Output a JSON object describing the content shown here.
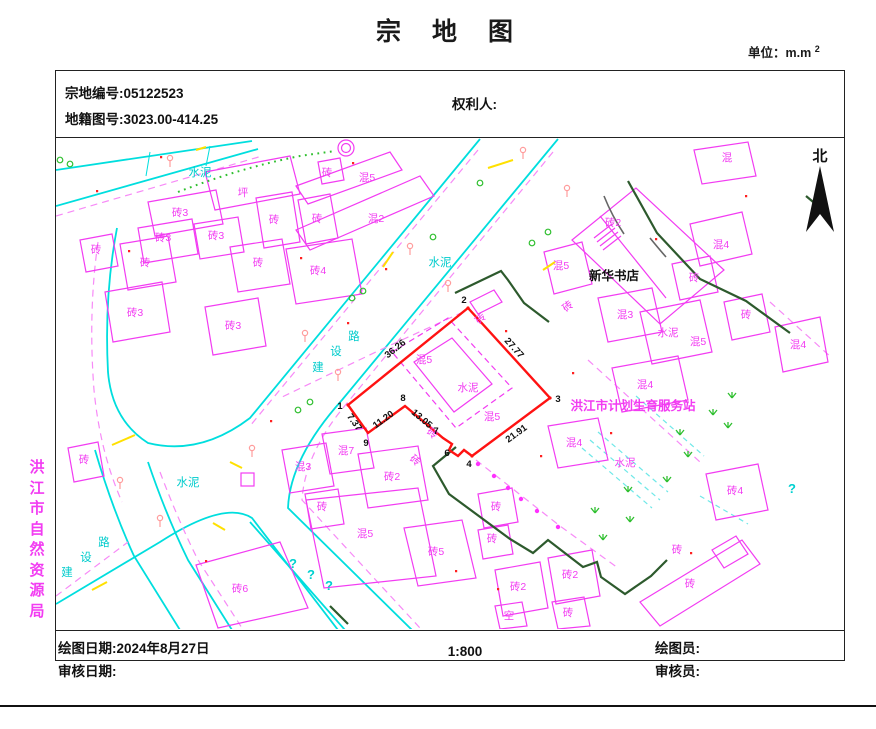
{
  "title": "宗 地 图",
  "unit_label": "单位：m.m",
  "unit_sup": "2",
  "header": {
    "parcel_no_label": "宗地编号:",
    "parcel_no": "05122523",
    "sheet_no_label": "地籍图号:",
    "sheet_no": "3023.00-414.25",
    "owner_label": "权利人:"
  },
  "footer": {
    "draw_date_label": "绘图日期:",
    "draw_date": "2024年8月27日",
    "audit_date_label": "审核日期:",
    "scale": "1:800",
    "drafter_label": "绘图员:",
    "auditor_label": "审核员:"
  },
  "compass_label": "北",
  "agency_vertical_text": "洪江市自然资源局",
  "map": {
    "parcel": {
      "vertex_labels": [
        {
          "t": "1",
          "x": 340,
          "y": 409
        },
        {
          "t": "2",
          "x": 464,
          "y": 303
        },
        {
          "t": "3",
          "x": 558,
          "y": 402
        },
        {
          "t": "4",
          "x": 469,
          "y": 467
        },
        {
          "t": "6",
          "x": 447,
          "y": 456
        },
        {
          "t": "7",
          "x": 436,
          "y": 434
        },
        {
          "t": "8",
          "x": 403,
          "y": 401
        },
        {
          "t": "9",
          "x": 366,
          "y": 446
        }
      ],
      "edge_labels": [
        {
          "t": "36.26",
          "x": 397,
          "y": 351,
          "rot": -39
        },
        {
          "t": "27.77",
          "x": 512,
          "y": 350,
          "rot": 48
        },
        {
          "t": "21.91",
          "x": 518,
          "y": 436,
          "rot": -36
        },
        {
          "t": "13.05",
          "x": 420,
          "y": 421,
          "rot": 40
        },
        {
          "t": "11.20",
          "x": 385,
          "y": 422,
          "rot": -36
        },
        {
          "t": "7.37",
          "x": 352,
          "y": 424,
          "rot": 54
        }
      ]
    },
    "place_labels": [
      {
        "t": "新华书店",
        "x": 614,
        "y": 280,
        "c": "black",
        "fs": 12.5,
        "b": 1
      },
      {
        "t": "洪江市计划生育服务站",
        "x": 633,
        "y": 410,
        "c": "magenta",
        "fs": 12.5,
        "b": 1
      }
    ],
    "road_labels": [
      {
        "t": "建",
        "x": 318,
        "y": 371,
        "c": "cyan"
      },
      {
        "t": "设",
        "x": 336,
        "y": 355,
        "c": "cyan"
      },
      {
        "t": "路",
        "x": 354,
        "y": 340,
        "c": "cyan"
      },
      {
        "t": "建",
        "x": 67,
        "y": 576,
        "c": "cyan"
      },
      {
        "t": "设",
        "x": 86,
        "y": 561,
        "c": "cyan"
      },
      {
        "t": "路",
        "x": 104,
        "y": 546,
        "c": "cyan"
      },
      {
        "t": "水泥",
        "x": 200,
        "y": 176,
        "c": "cyan"
      },
      {
        "t": "水泥",
        "x": 440,
        "y": 266,
        "c": "cyan"
      },
      {
        "t": "水泥",
        "x": 188,
        "y": 486,
        "c": "cyan"
      }
    ],
    "surface_labels": [
      {
        "t": "水泥",
        "x": 468,
        "y": 391,
        "c": "magenta"
      },
      {
        "t": "水泥",
        "x": 668,
        "y": 336,
        "c": "magenta"
      },
      {
        "t": "水泥",
        "x": 625,
        "y": 466,
        "c": "magenta"
      }
    ],
    "question_marks": [
      {
        "t": "?",
        "x": 293,
        "y": 568
      },
      {
        "t": "?",
        "x": 311,
        "y": 579
      },
      {
        "t": "?",
        "x": 329,
        "y": 590
      },
      {
        "t": "?",
        "x": 792,
        "y": 493
      }
    ],
    "building_labels": [
      {
        "t": "坪",
        "x": 243,
        "y": 196
      },
      {
        "t": "砖3",
        "x": 180,
        "y": 216
      },
      {
        "t": "砖",
        "x": 327,
        "y": 176
      },
      {
        "t": "混5",
        "x": 367,
        "y": 181
      },
      {
        "t": "混2",
        "x": 376,
        "y": 222
      },
      {
        "t": "砖",
        "x": 274,
        "y": 223
      },
      {
        "t": "砖",
        "x": 317,
        "y": 222
      },
      {
        "t": "砖3",
        "x": 163,
        "y": 241
      },
      {
        "t": "砖3",
        "x": 216,
        "y": 239
      },
      {
        "t": "砖",
        "x": 145,
        "y": 266
      },
      {
        "t": "砖",
        "x": 258,
        "y": 266
      },
      {
        "t": "砖4",
        "x": 318,
        "y": 274
      },
      {
        "t": "砖",
        "x": 96,
        "y": 253
      },
      {
        "t": "砖3",
        "x": 135,
        "y": 316
      },
      {
        "t": "砖3",
        "x": 233,
        "y": 329
      },
      {
        "t": "砖2",
        "x": 613,
        "y": 226
      },
      {
        "t": "混",
        "x": 727,
        "y": 161
      },
      {
        "t": "混4",
        "x": 721,
        "y": 248
      },
      {
        "t": "砖",
        "x": 694,
        "y": 281
      },
      {
        "t": "砖",
        "x": 746,
        "y": 318
      },
      {
        "t": "混5",
        "x": 561,
        "y": 269
      },
      {
        "t": "混4",
        "x": 798,
        "y": 348
      },
      {
        "t": "混3",
        "x": 625,
        "y": 318
      },
      {
        "t": "混5",
        "x": 698,
        "y": 345
      },
      {
        "t": "混4",
        "x": 645,
        "y": 388
      },
      {
        "t": "混4",
        "x": 574,
        "y": 446
      },
      {
        "t": "砖4",
        "x": 735,
        "y": 494
      },
      {
        "t": "混3",
        "x": 303,
        "y": 470
      },
      {
        "t": "混7",
        "x": 346,
        "y": 454
      },
      {
        "t": "砖2",
        "x": 392,
        "y": 480
      },
      {
        "t": "砖",
        "x": 322,
        "y": 510
      },
      {
        "t": "混5",
        "x": 365,
        "y": 537
      },
      {
        "t": "砖5",
        "x": 436,
        "y": 555
      },
      {
        "t": "砖",
        "x": 496,
        "y": 510
      },
      {
        "t": "砖",
        "x": 492,
        "y": 542
      },
      {
        "t": "砖2",
        "x": 518,
        "y": 590
      },
      {
        "t": "砖2",
        "x": 570,
        "y": 578
      },
      {
        "t": "空",
        "x": 509,
        "y": 619
      },
      {
        "t": "砖",
        "x": 568,
        "y": 616
      },
      {
        "t": "砖6",
        "x": 240,
        "y": 592
      },
      {
        "t": "砖",
        "x": 84,
        "y": 463
      },
      {
        "t": "砖",
        "x": 690,
        "y": 587
      },
      {
        "t": "砖",
        "x": 677,
        "y": 553
      },
      {
        "t": "混5",
        "x": 424,
        "y": 363
      },
      {
        "t": "混5",
        "x": 492,
        "y": 420
      },
      {
        "t": "砖",
        "x": 483,
        "y": 321,
        "rot": -45
      },
      {
        "t": "砖",
        "x": 430,
        "y": 436,
        "rot": 40
      },
      {
        "t": "砖",
        "x": 413,
        "y": 463,
        "rot": 40
      },
      {
        "t": "砖",
        "x": 570,
        "y": 309,
        "rot": -40
      }
    ]
  }
}
